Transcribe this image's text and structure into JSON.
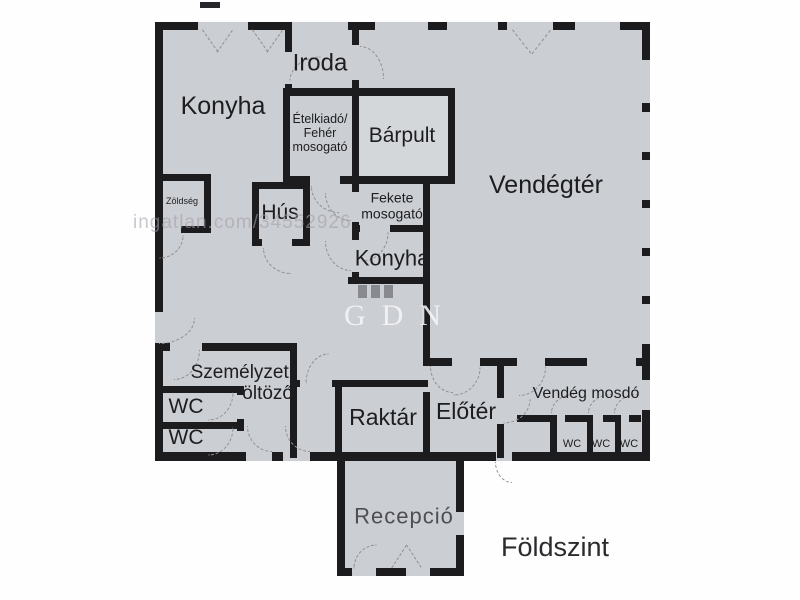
{
  "floor_plan": {
    "floor_label": "Földszint",
    "rooms": {
      "konyha_main": {
        "label": "Konyha"
      },
      "iroda": {
        "label": "Iroda"
      },
      "etelkiado": {
        "label": "Ételkiadó/\nFehér\nmosogató"
      },
      "barpult": {
        "label": "Bárpult"
      },
      "vendegter": {
        "label": "Vendégtér"
      },
      "zoldseg": {
        "label": "Zöldség"
      },
      "hus": {
        "label": "Hús"
      },
      "fekete_mosogato": {
        "label": "Fekete\nmosogató"
      },
      "konyha_small": {
        "label": "Konyha"
      },
      "szemelyzeti_oltozo": {
        "label": "Személyzeti\nöltöző"
      },
      "wc_upper": {
        "label": "WC"
      },
      "wc_lower": {
        "label": "WC"
      },
      "raktar": {
        "label": "Raktár"
      },
      "eloter": {
        "label": "Előtér"
      },
      "vendeg_mosdo": {
        "label": "Vendég mosdó"
      },
      "wc_stalls": [
        "WC",
        "WC",
        "WC"
      ],
      "recepcio": {
        "label": "Recepció"
      }
    },
    "watermarks": {
      "listing": "ingatlan.com/34552926",
      "agency": "GDN"
    },
    "colors": {
      "floor": "#cbced2",
      "wall": "#1c1c1e",
      "counter_fill": "#d4d7da"
    }
  }
}
